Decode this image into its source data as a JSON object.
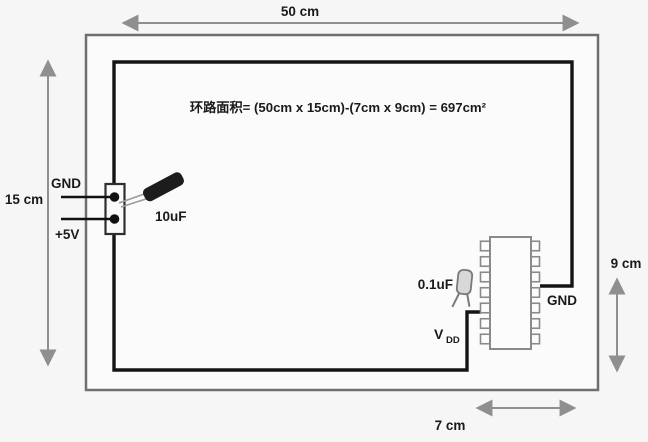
{
  "diagram": {
    "formula": "环路面积= (50cm x 15cm)-(7cm x 9cm) = 697cm²",
    "dimensions": {
      "top": "50 cm",
      "left": "15 cm",
      "right": "9 cm",
      "bottom": "7 cm"
    },
    "connector": {
      "gnd_label": "GND",
      "plus5v_label": "+5V"
    },
    "bulk_capacitor_label": "10uF",
    "bypass_capacitor_label": "0.1uF",
    "ic": {
      "vdd_label_main": "V",
      "vdd_label_sub": "DD",
      "gnd_label": "GND",
      "pins_per_side": 14
    }
  },
  "colors": {
    "background": "#f6f6f6",
    "board_outline": "#6f6f6f",
    "loop_trace": "#141414",
    "dimension_arrows": "#8f8f8f",
    "text": "#1a1a1a",
    "capacitor_body": "#1c1c1c"
  }
}
